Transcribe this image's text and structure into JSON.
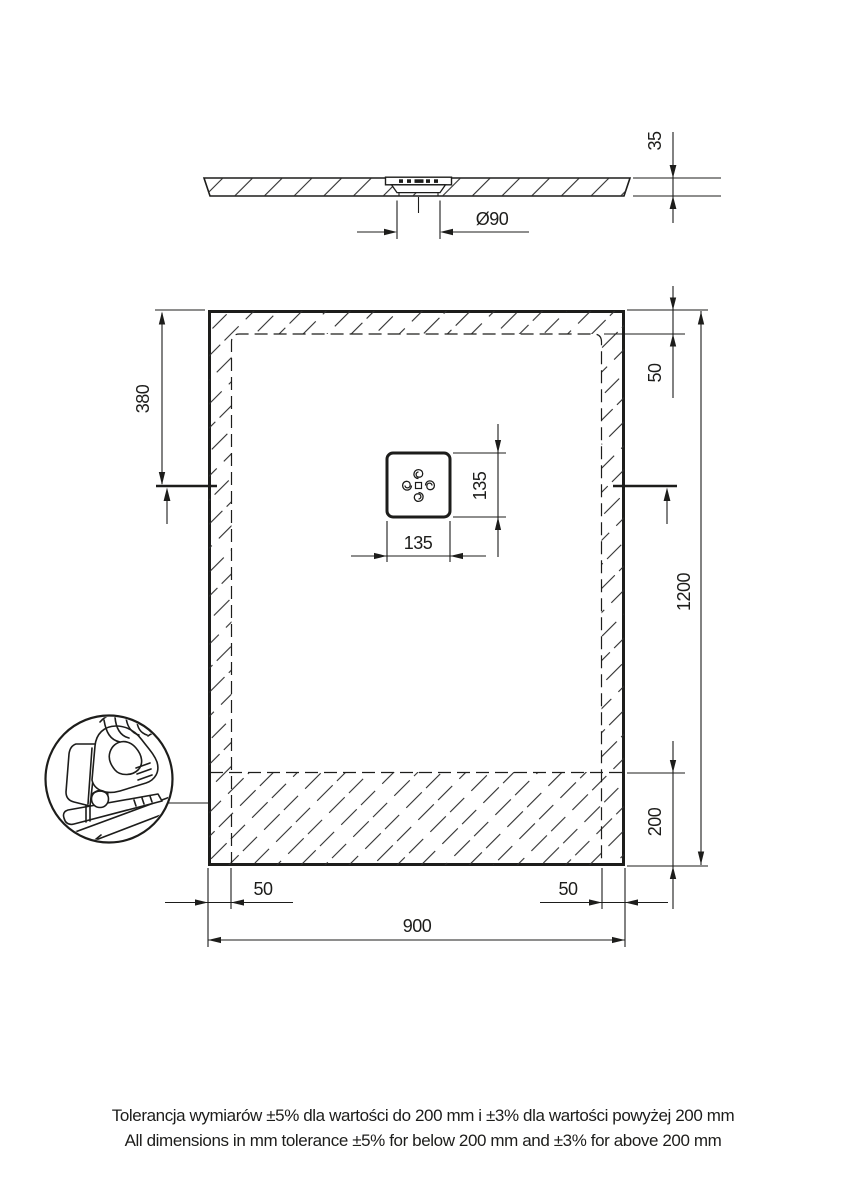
{
  "drawing": {
    "side_view": {
      "thickness": "35",
      "drain_diameter": "Ø90"
    },
    "plan_view": {
      "length": "1200",
      "width": "900",
      "drain_center_from_top": "380",
      "side_margin_top_right": "50",
      "bottom_cut_zone": "200",
      "bottom_margin_left": "50",
      "bottom_margin_right": "50",
      "drain_square_width": "135",
      "drain_square_height": "135"
    },
    "detail_icon": "jigsaw-icon",
    "notes": {
      "line1": "Tolerancja wymiarów ±5% dla wartości do 200 mm i ±3% dla wartości powyżej 200 mm",
      "line2": "All dimensions in mm tolerance ±5% for below 200 mm and ±3% for above 200 mm"
    },
    "colors": {
      "line": "#1d1d1b",
      "background": "#ffffff"
    }
  }
}
